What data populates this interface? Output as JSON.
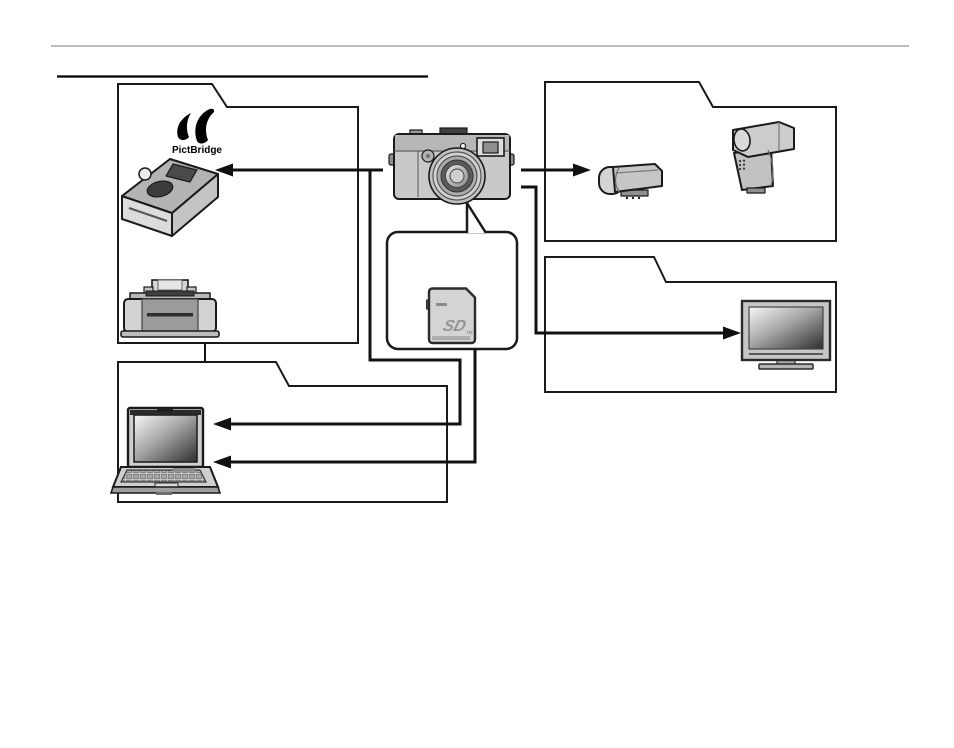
{
  "page": {
    "width": 954,
    "height": 748,
    "background": "#ffffff"
  },
  "rules": {
    "top_rule_color": "#a8a8a8",
    "heading_underline_color": "#000000"
  },
  "palette": {
    "ink": "#1a1a1a",
    "device_gray": "#c9c9c9",
    "device_gray_dark": "#9b9b9b",
    "screen_gradient_light": "#f5f5f5",
    "screen_gradient_dark": "#2e2e2e"
  },
  "labels": {
    "pictbridge_mark": "’’",
    "pictbridge": "PictBridge",
    "sd_logo": "SD",
    "sd_tm": "TM"
  },
  "diagram": {
    "nodes": [
      {
        "id": "camera",
        "name": "digital-camera"
      },
      {
        "id": "pictbridge-photo-printer",
        "name": "pictbridge-photo-printer",
        "group": "printer-group"
      },
      {
        "id": "inkjet-printer",
        "name": "inkjet-printer",
        "group": "printer-group"
      },
      {
        "id": "small-flash",
        "name": "clip-on-flash-unit",
        "group": "flash-group"
      },
      {
        "id": "large-flash",
        "name": "shoe-mount-flash-unit",
        "group": "flash-group"
      },
      {
        "id": "television",
        "name": "flat-screen-tv",
        "group": "tv-group"
      },
      {
        "id": "laptop",
        "name": "laptop-computer",
        "group": "computer-group"
      },
      {
        "id": "memory-card",
        "name": "sd-memory-card",
        "group": "card-callout"
      }
    ],
    "connections": [
      {
        "from": "camera",
        "to": "pictbridge-photo-printer",
        "style": "arrow-left"
      },
      {
        "from": "camera",
        "to": "small-flash",
        "style": "arrow-right"
      },
      {
        "from": "camera",
        "to": "television",
        "style": "arrow-right"
      },
      {
        "from": "camera",
        "to": "laptop",
        "style": "arrow-left"
      },
      {
        "from": "memory-card",
        "to": "laptop",
        "style": "arrow-left"
      },
      {
        "from": "camera",
        "to": "memory-card",
        "style": "callout-tail"
      },
      {
        "from": "printer-group",
        "to": "computer-group",
        "style": "plain-link"
      }
    ]
  }
}
